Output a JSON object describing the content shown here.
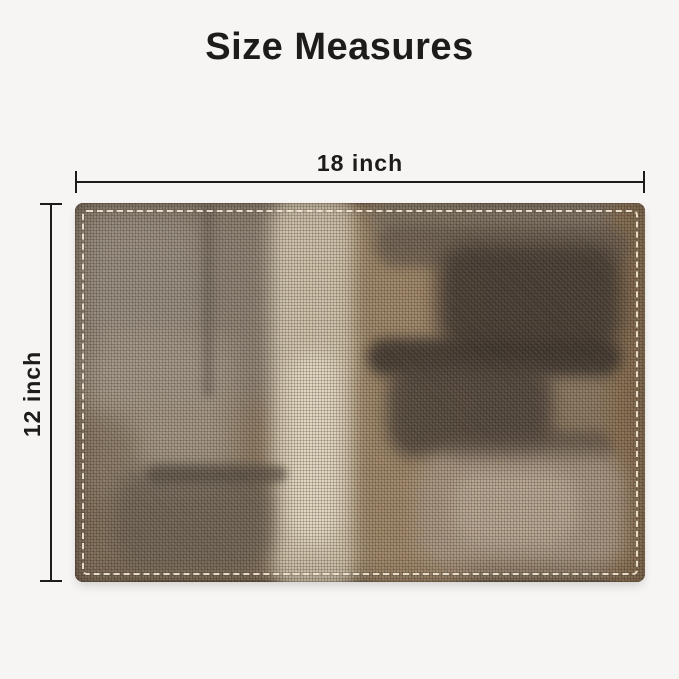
{
  "title": "Size Measures",
  "dimensions": {
    "width_label": "18 inch",
    "height_label": "12 inch"
  },
  "colors": {
    "background": "#f6f5f3",
    "ink": "#1d1c1a",
    "stitch": "#ece2d0",
    "mat_base": "#8d7a63",
    "mat_grey": "#8e8376",
    "mat_grey_light": "#a89c8c",
    "mat_cream": "#d2c6ae",
    "mat_cream_bright": "#e6dcc6",
    "mat_tan": "#a58c6c",
    "mat_dark": "#453c34",
    "mat_darkest": "#3a332d",
    "mat_brown_right": "#8a7053",
    "mat_scumble": "#ab9a88",
    "mat_patch_grey": "#6d6356"
  }
}
